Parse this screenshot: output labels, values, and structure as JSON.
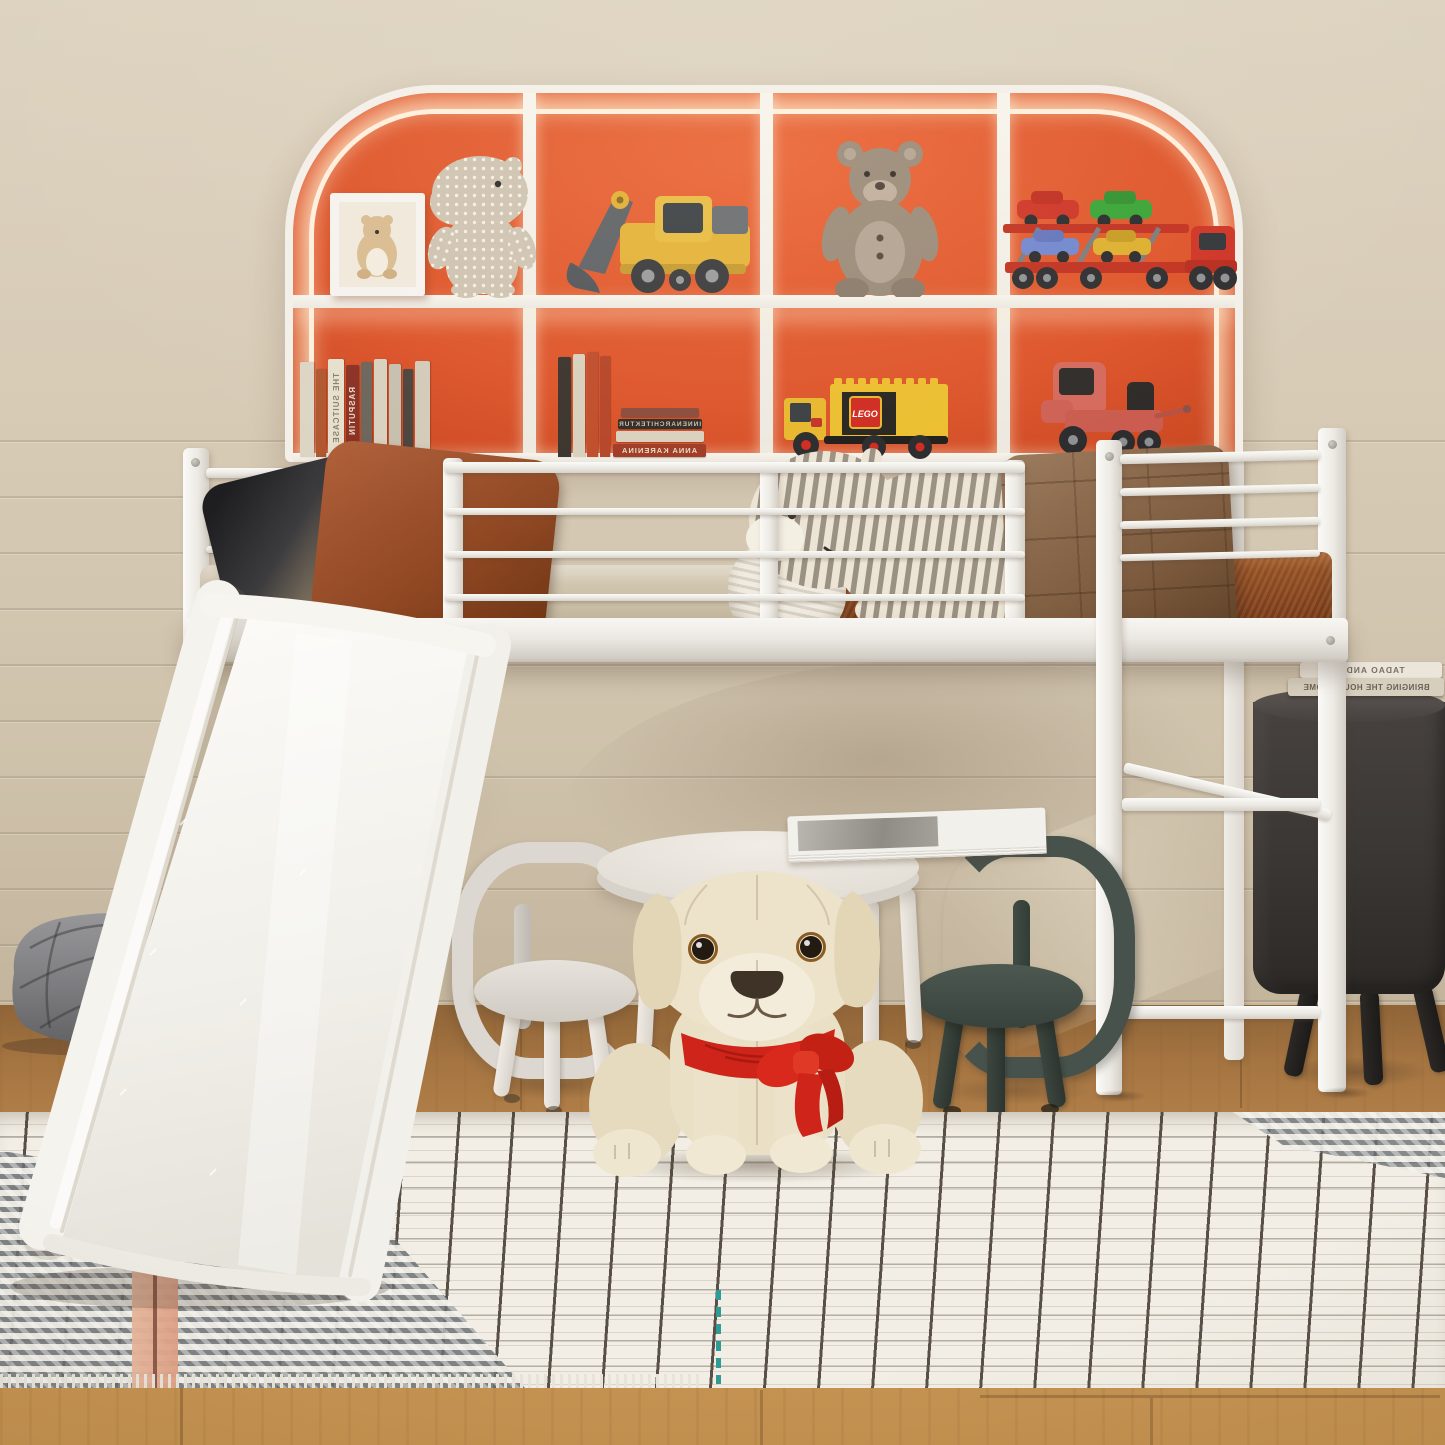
{
  "meta": {
    "domain": "natural-image",
    "description": "3D product photo of a kids bedroom: a white metal loft bed with guardrails, side ladder and a left-hand slide; an arched orange backlit display bookcase filled with toys and books; brown bedding; a round kids play table with two toddler chairs; a plush puppy with a red scarf sitting on a black-and-white windowpane rug",
    "canvas": {
      "width": 1445,
      "height": 1445
    }
  },
  "palette": {
    "wall": "#d5c9b3",
    "floor_wood": "#b5824e",
    "shelf_orange": "#d8532a",
    "shelf_frame": "#f3f0e9",
    "led_glow": "#fff6e1",
    "bed_white": "#f4f2ed",
    "sheet_beige": "#c9bda4",
    "blanket_brown": "#7e4220",
    "cushion_brown": "#84613f",
    "pillow_dark": "#2f2f33",
    "pillow_rust": "#9a5128",
    "plush_stripe_gray": "#9a9183",
    "slide_white": "#f5f3ee",
    "pouf_gray": "#87878a",
    "table_white": "#e9e5de",
    "chair_white": "#d9d5ce",
    "chair_green": "#47524c",
    "dog_cream": "#ece2ca",
    "scarf_red": "#d0271b",
    "side_table_dark": "#3b3734",
    "lego_yellow": "#e9bb2d",
    "lego_red": "#cf2a1f",
    "toy_truck_red": "#d4695c",
    "excavator_yellow": "#e5b237",
    "teddy_brown": "#9b8a78",
    "car_red": "#cf3526",
    "car_green": "#3aa536",
    "car_blue": "#7287cf",
    "car_yellow": "#ddb02e",
    "hippo_gray": "#cfc3b1",
    "rug_base": "#f2eee5",
    "rug_grid": "#322b22",
    "rug_pink": "#e3ac90",
    "rug_teal": "#3aa6a0"
  },
  "texts": {
    "lego_logo": "LEGO",
    "shelf_books_mirrored": [
      "THE SUITCASE",
      "RASPUTIN",
      "INNENARCHITEKTUR",
      "ANNA KARENINA"
    ],
    "side_table_books_mirrored": [
      "TADAO ANDO",
      "BRINGING THE HOUSE HOME"
    ]
  },
  "bookcase": {
    "shape": "rounded arch with warm LED edge glow",
    "grid": "4 columns x 2 rows",
    "top_row_items": [
      "bear art print in white frame",
      "polka-dot plush hippo",
      "wooden toy excavator",
      "plush teddy bear",
      "toy car-carrier truck with red, green, blue and yellow cars"
    ],
    "bottom_row_items": [
      "row of books",
      "books with horizontal stack",
      "yellow LEGO delivery truck",
      "red toy truck"
    ]
  },
  "bed": {
    "type": "twin metal loft bed",
    "color": "white",
    "features": [
      "headboard",
      "full-length guardrail",
      "footboard",
      "side ladder with diagonal brace",
      "left slide"
    ],
    "bedding": [
      "beige fitted sheet",
      "brown textured blanket",
      "black pillow",
      "rust pillow",
      "gray striped plush hippo",
      "white ribbed pillow",
      "brown quilted back cushion"
    ]
  },
  "under_bed": {
    "items": [
      "round white kids table with magazine on top",
      "white toddler chair",
      "dark green toddler chair",
      "cream plush puppy with red scarf bow"
    ]
  },
  "right_side": {
    "items": [
      "dark drum side table with splayed legs",
      "two stacked hardcover books"
    ]
  },
  "left_side": {
    "items": [
      "gray quilted floor pouf"
    ]
  },
  "rug": {
    "pattern": "white windowpane check with black grid lines, gray chevron band with blush pink stripes, teal accent dashes, fringed edge"
  }
}
